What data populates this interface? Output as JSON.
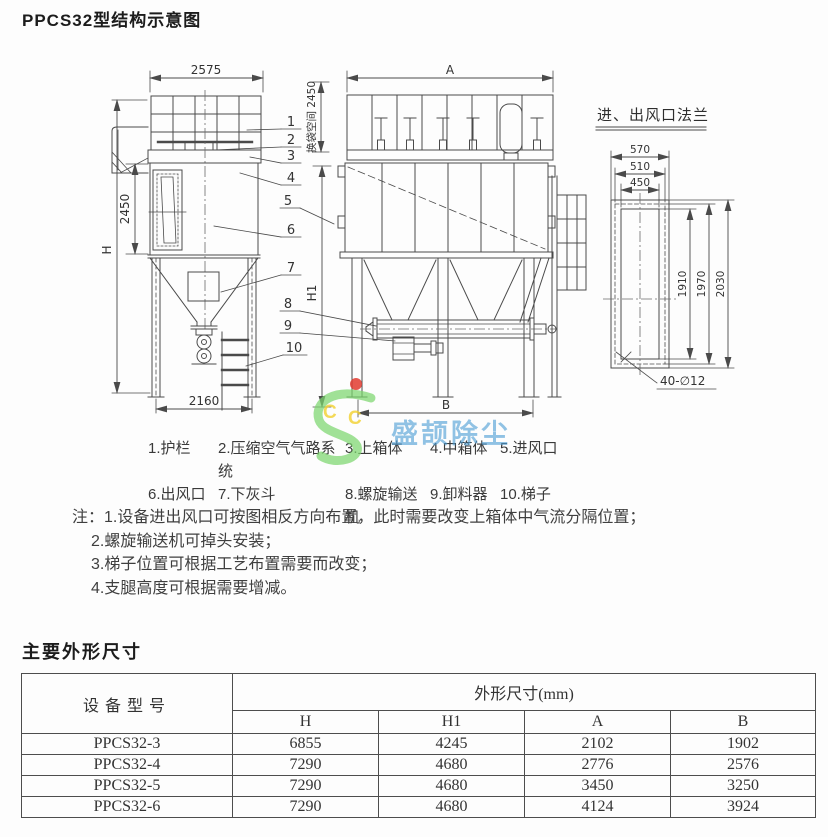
{
  "page_title": "PPCS32型结构示意图",
  "drawing": {
    "side_view": {
      "dim_top_width": "2575",
      "dim_body_height": "2450",
      "dim_overall_height": "H",
      "dim_base_width": "2160"
    },
    "front_view": {
      "dim_top_width": "A",
      "dim_lower_height": "H1",
      "dim_bag_space": "换袋空间 2450",
      "dim_base_width": "B"
    },
    "flange_view": {
      "title": "进、出风口法兰",
      "dim_outer_width": "570",
      "dim_bolt_width": "510",
      "dim_opening_width": "450",
      "dim_opening_height": "1910",
      "dim_bolt_height": "1970",
      "dim_outer_height": "2030",
      "bolt_spec": "40-∅12"
    },
    "callouts": [
      "1",
      "2",
      "3",
      "4",
      "5",
      "6",
      "7",
      "8",
      "9",
      "10"
    ]
  },
  "legend": {
    "items": [
      "1.护栏",
      "2.压缩空气气路系统",
      "3.上箱体",
      "4.中箱体",
      "5.进风口",
      "6.出风口",
      "7.下灰斗",
      "8.螺旋输送机",
      "9.卸料器",
      "10.梯子"
    ]
  },
  "notes": {
    "prefix": "注：",
    "lines": [
      "1.设备进出风口可按图相反方向布置，此时需要改变上箱体中气流分隔位置；",
      "2.螺旋输送机可掉头安装；",
      "3.梯子位置可根据工艺布置需要而改变；",
      "4.支腿高度可根据需要增减。"
    ]
  },
  "dimensions_table": {
    "heading": "主要外形尺寸",
    "header": {
      "model": "设备型号",
      "group": "外形尺寸(mm)",
      "columns": [
        "H",
        "H1",
        "A",
        "B"
      ]
    },
    "rows": [
      {
        "model": "PPCS32-3",
        "H": "6855",
        "H1": "4245",
        "A": "2102",
        "B": "1902"
      },
      {
        "model": "PPCS32-4",
        "H": "7290",
        "H1": "4680",
        "A": "2776",
        "B": "2576"
      },
      {
        "model": "PPCS32-5",
        "H": "7290",
        "H1": "4680",
        "A": "3450",
        "B": "3250"
      },
      {
        "model": "PPCS32-6",
        "H": "7290",
        "H1": "4680",
        "A": "4124",
        "B": "3924"
      }
    ]
  },
  "watermark": {
    "text": "盛颉除尘",
    "letter1": "C",
    "letter2": "C",
    "colors": {
      "green": "#7bd66d",
      "yellow": "#f2d12e",
      "red": "#e23b30",
      "blue": "#4d9ed5"
    }
  }
}
